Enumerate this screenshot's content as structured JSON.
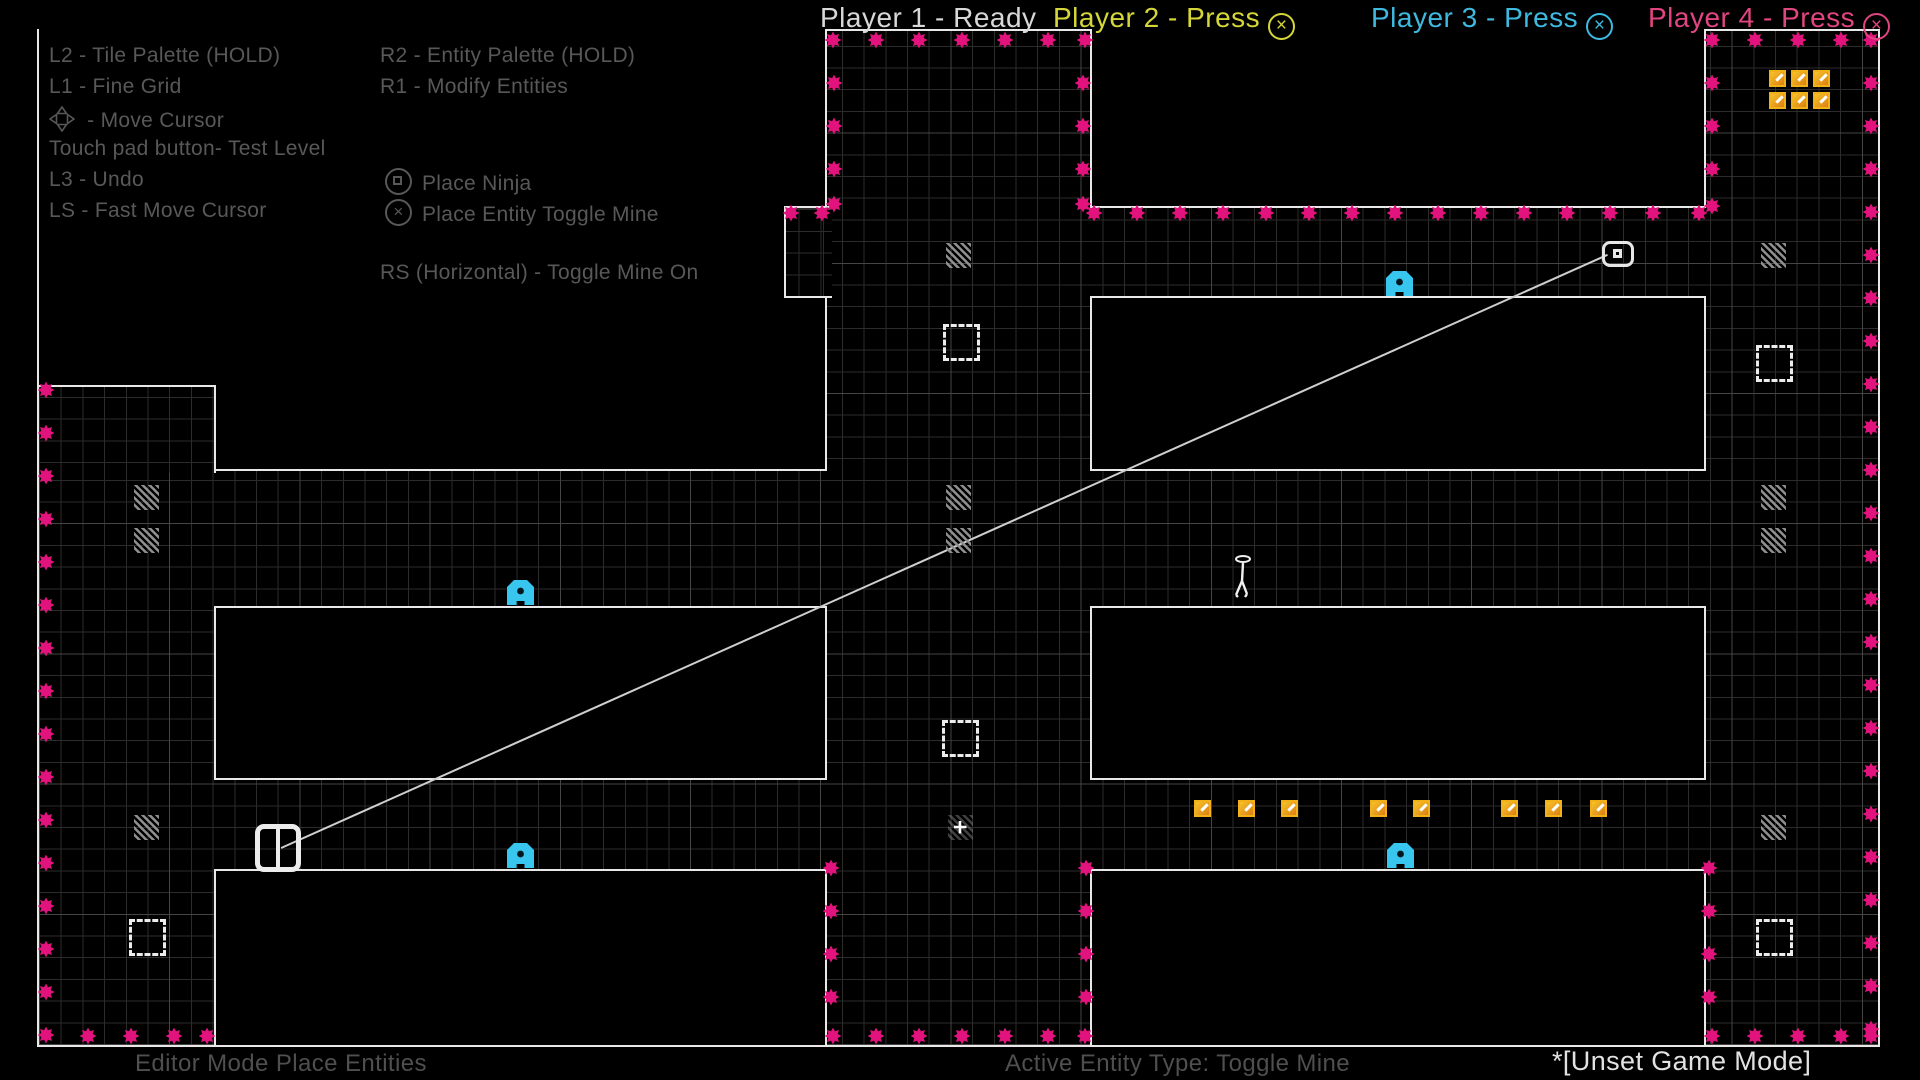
{
  "header": {
    "players": [
      {
        "label": "Player 1 - Ready",
        "color": "#d8d8d8",
        "icon": null,
        "x": 820
      },
      {
        "label": "Player 2 - Press",
        "color": "#d6d63a",
        "icon": "cross-circle",
        "x": 1053
      },
      {
        "label": "Player 3 - Press",
        "color": "#3fb9e0",
        "icon": "cross-circle",
        "x": 1371
      },
      {
        "label": "Player 4 - Press",
        "color": "#e0457f",
        "icon": "cross-circle",
        "x": 1648
      }
    ]
  },
  "instructions": {
    "left": [
      {
        "text": "L2 - Tile Palette (HOLD)",
        "x": 49,
        "y": 44
      },
      {
        "text": "L1 - Fine Grid",
        "x": 49,
        "y": 75
      },
      {
        "text": "- Move Cursor",
        "icon": "dpad-icon",
        "x": 49,
        "y": 106
      },
      {
        "text": "Touch pad button- Test Level",
        "x": 49,
        "y": 137
      },
      {
        "text": "L3 - Undo",
        "x": 49,
        "y": 168
      },
      {
        "text": "LS - Fast Move Cursor",
        "x": 49,
        "y": 199
      }
    ],
    "right": [
      {
        "text": "R2 - Entity Palette (HOLD)",
        "x": 380,
        "y": 44
      },
      {
        "text": "R1 - Modify Entities",
        "x": 380,
        "y": 75
      },
      {
        "text": "Place Ninja",
        "icon": "square-circle-icon",
        "x": 385,
        "y": 168
      },
      {
        "text": "Place Entity Toggle Mine",
        "icon": "cross-circle-icon",
        "x": 385,
        "y": 199
      },
      {
        "text": "RS (Horizontal) - Toggle Mine On",
        "x": 380,
        "y": 261
      }
    ]
  },
  "footer": {
    "mode": "Editor Mode Place Entities",
    "active_entity": "Active Entity Type: Toggle Mine",
    "game_mode": "*[Unset Game Mode]"
  },
  "colors": {
    "mine": "#e2137d",
    "gold": "#f2b019",
    "blue_entity": "#38c6ef",
    "grid_fine": "#2c2c2c",
    "grid_coarse": "#454545",
    "outline": "#e8e8e8",
    "instruction_text": "#585858"
  },
  "level": {
    "frame": {
      "x": 37,
      "y": 29,
      "w": 1843,
      "h": 1018,
      "segments": [
        {
          "x": 37,
          "y": 29,
          "w": 2,
          "h": 1018
        },
        {
          "x": 1878,
          "y": 29,
          "w": 2,
          "h": 1018
        },
        {
          "x": 37,
          "y": 1045,
          "w": 1843,
          "h": 2
        },
        {
          "x": 37,
          "y": 29,
          "w": 165,
          "h": 2
        },
        {
          "x": 825,
          "y": 29,
          "w": 267,
          "h": 2
        },
        {
          "x": 1704,
          "y": 29,
          "w": 176,
          "h": 2
        }
      ]
    },
    "walls": [
      {
        "x": 39,
        "y": 29,
        "w": 788,
        "h": 442,
        "noTop": true,
        "noLeft": true
      },
      {
        "x": 1090,
        "y": 29,
        "w": 616,
        "h": 179,
        "noTop": true
      },
      {
        "x": 1090,
        "y": 296,
        "w": 616,
        "h": 175
      },
      {
        "x": 214,
        "y": 606,
        "w": 613,
        "h": 174
      },
      {
        "x": 1090,
        "y": 606,
        "w": 616,
        "h": 174
      },
      {
        "x": 214,
        "y": 869,
        "w": 613,
        "h": 176,
        "noBottom": true
      },
      {
        "x": 1090,
        "y": 869,
        "w": 616,
        "h": 176,
        "noBottom": true
      }
    ],
    "patches": [
      {
        "x": 39,
        "y": 385,
        "w": 177,
        "h": 88,
        "borders": [
          "top",
          "right"
        ]
      },
      {
        "x": 784,
        "y": 206,
        "w": 48,
        "h": 92,
        "borders": [
          "top",
          "left",
          "bottom"
        ]
      }
    ],
    "mines": [
      [
        833,
        40
      ],
      [
        876,
        40
      ],
      [
        919,
        40
      ],
      [
        962,
        40
      ],
      [
        1005,
        40
      ],
      [
        1048,
        40
      ],
      [
        1085,
        40
      ],
      [
        834,
        83
      ],
      [
        834,
        126
      ],
      [
        834,
        169
      ],
      [
        834,
        204
      ],
      [
        1083,
        83
      ],
      [
        1083,
        126
      ],
      [
        1083,
        169
      ],
      [
        1083,
        204
      ],
      [
        791,
        213
      ],
      [
        822,
        213
      ],
      [
        1094,
        213
      ],
      [
        1137,
        213
      ],
      [
        1180,
        213
      ],
      [
        1223,
        213
      ],
      [
        1266,
        213
      ],
      [
        1309,
        213
      ],
      [
        1352,
        213
      ],
      [
        1395,
        213
      ],
      [
        1438,
        213
      ],
      [
        1481,
        213
      ],
      [
        1524,
        213
      ],
      [
        1567,
        213
      ],
      [
        1610,
        213
      ],
      [
        1653,
        213
      ],
      [
        1699,
        213
      ],
      [
        1712,
        40
      ],
      [
        1755,
        40
      ],
      [
        1798,
        40
      ],
      [
        1841,
        40
      ],
      [
        1871,
        40
      ],
      [
        1712,
        83
      ],
      [
        1712,
        126
      ],
      [
        1712,
        169
      ],
      [
        1712,
        206
      ],
      [
        1871,
        83
      ],
      [
        1871,
        126
      ],
      [
        1871,
        169
      ],
      [
        1871,
        212
      ],
      [
        1871,
        255
      ],
      [
        1871,
        298
      ],
      [
        1871,
        341
      ],
      [
        1871,
        384
      ],
      [
        1871,
        427
      ],
      [
        1871,
        470
      ],
      [
        1871,
        513
      ],
      [
        1871,
        556
      ],
      [
        1871,
        599
      ],
      [
        1871,
        642
      ],
      [
        1871,
        685
      ],
      [
        1871,
        728
      ],
      [
        1871,
        771
      ],
      [
        1871,
        814
      ],
      [
        1871,
        857
      ],
      [
        1871,
        900
      ],
      [
        1871,
        943
      ],
      [
        1871,
        986
      ],
      [
        1871,
        1029
      ],
      [
        46,
        390
      ],
      [
        46,
        433
      ],
      [
        46,
        476
      ],
      [
        46,
        519
      ],
      [
        46,
        562
      ],
      [
        46,
        605
      ],
      [
        46,
        648
      ],
      [
        46,
        691
      ],
      [
        46,
        734
      ],
      [
        46,
        777
      ],
      [
        46,
        820
      ],
      [
        46,
        863
      ],
      [
        46,
        906
      ],
      [
        46,
        949
      ],
      [
        46,
        992
      ],
      [
        46,
        1035
      ],
      [
        88,
        1036
      ],
      [
        131,
        1036
      ],
      [
        174,
        1036
      ],
      [
        207,
        1036
      ],
      [
        831,
        868
      ],
      [
        831,
        911
      ],
      [
        831,
        954
      ],
      [
        831,
        997
      ],
      [
        1086,
        868
      ],
      [
        1086,
        911
      ],
      [
        1086,
        954
      ],
      [
        1086,
        997
      ],
      [
        833,
        1036
      ],
      [
        876,
        1036
      ],
      [
        919,
        1036
      ],
      [
        962,
        1036
      ],
      [
        1005,
        1036
      ],
      [
        1048,
        1036
      ],
      [
        1085,
        1036
      ],
      [
        1709,
        868
      ],
      [
        1709,
        911
      ],
      [
        1709,
        954
      ],
      [
        1709,
        997
      ],
      [
        1712,
        1036
      ],
      [
        1755,
        1036
      ],
      [
        1798,
        1036
      ],
      [
        1841,
        1036
      ],
      [
        1871,
        1036
      ]
    ],
    "gold": [
      [
        1777,
        78
      ],
      [
        1799,
        78
      ],
      [
        1821,
        78
      ],
      [
        1777,
        100
      ],
      [
        1799,
        100
      ],
      [
        1821,
        100
      ],
      [
        1202,
        808
      ],
      [
        1246,
        808
      ],
      [
        1289,
        808
      ],
      [
        1378,
        808
      ],
      [
        1421,
        808
      ],
      [
        1509,
        808
      ],
      [
        1553,
        808
      ],
      [
        1598,
        808
      ]
    ],
    "blue_entities": [
      [
        520,
        592
      ],
      [
        1399,
        283
      ],
      [
        520,
        855
      ],
      [
        1400,
        855
      ]
    ],
    "dashed_squares": [
      [
        961,
        342
      ],
      [
        960,
        738
      ],
      [
        1774,
        363
      ],
      [
        147,
        937
      ],
      [
        1774,
        937
      ]
    ],
    "hatch_markers": [
      [
        146,
        497
      ],
      [
        146,
        540
      ],
      [
        146,
        827
      ],
      [
        958,
        255
      ],
      [
        958,
        497
      ],
      [
        958,
        540
      ],
      [
        1773,
        255
      ],
      [
        1773,
        497
      ],
      [
        1773,
        540
      ],
      [
        1773,
        827
      ]
    ],
    "cursor_marker": {
      "x": 960,
      "y": 827
    },
    "ninja": {
      "x": 1243,
      "y": 580
    },
    "editor_cursor": {
      "x": 255,
      "y": 824
    },
    "drone": {
      "x": 1602,
      "y": 241
    },
    "wire": {
      "x1": 281,
      "y1": 847,
      "x2": 1607,
      "y2": 254
    }
  }
}
